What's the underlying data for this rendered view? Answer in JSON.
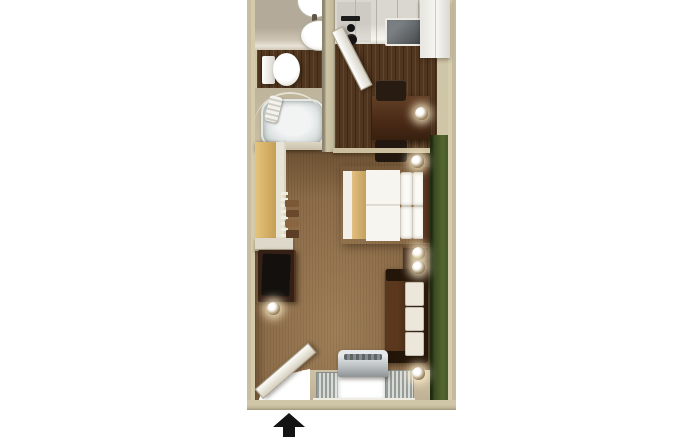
{
  "scene": {
    "title": "Studio suite 3D floor plan",
    "type": "floor-plan-render",
    "entrance_marker": "arrow-up"
  },
  "palette": {
    "page_bg": "#ffffff",
    "wall_beige": "#cfc5a7",
    "wall_shadow": "#a89e80",
    "accent_wall_green": "#4a5c2c",
    "carpet_brown": "#8b6b47",
    "wood_floor_dark": "#50361f",
    "closet_tan": "#d8b56c",
    "furniture_espresso": "#3d2414",
    "linen_white": "#f6f4ee",
    "appliance_white": "#f2f1ec",
    "glass_white": "#ffffff",
    "ac_gray": "#aab0b2",
    "arrow_black": "#141414"
  },
  "rooms": {
    "bathroom": {
      "name": "bathroom",
      "fixtures": [
        "pedestal sink",
        "toilet",
        "bathtub",
        "curved shower rod",
        "towels"
      ]
    },
    "kitchen": {
      "name": "kitchen",
      "fixtures": [
        "two-burner cooktop",
        "kitchen sink",
        "refrigerator",
        "table",
        "two chairs"
      ]
    },
    "main_room": {
      "name": "sleeping-living area",
      "fixtures": [
        "queen bed",
        "headboard",
        "nightstand",
        "closet with hangers",
        "dresser with tv",
        "sofa",
        "wall sconces"
      ]
    },
    "entry": {
      "name": "entry",
      "fixtures": [
        "entry door",
        "window with blinds",
        "ptac air conditioner"
      ]
    }
  }
}
